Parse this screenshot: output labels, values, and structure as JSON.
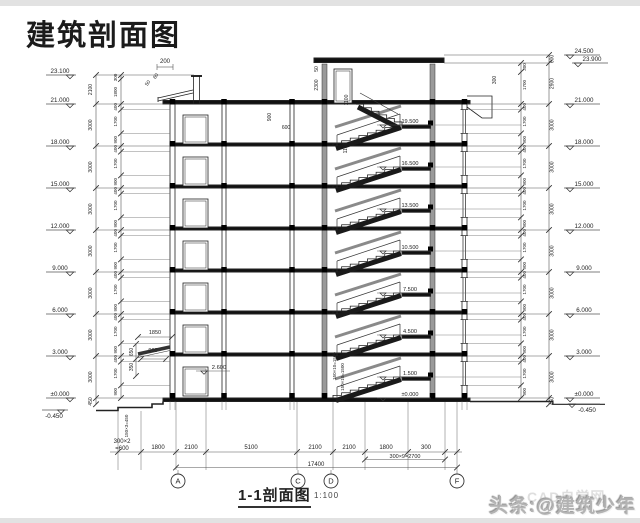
{
  "title": "建筑剖面图",
  "caption": {
    "label": "1-1剖面图",
    "scale": "1:100"
  },
  "watermark": {
    "main": "头条:@建筑少年",
    "behind": "CAD自学网"
  },
  "colors": {
    "line": "#222",
    "dim": "#555",
    "wall_gray": "#9a9a9a",
    "watermark_gray": "#b3b3b3"
  },
  "grid_bubbles": [
    {
      "label": "A",
      "x": 178
    },
    {
      "label": "C",
      "x": 298
    },
    {
      "label": "D",
      "x": 331
    },
    {
      "label": "F",
      "x": 457
    }
  ],
  "left_elevations": [
    {
      "v": "23.100",
      "y": 75
    },
    {
      "v": "21.000",
      "y": 104
    },
    {
      "v": "18.000",
      "y": 146
    },
    {
      "v": "15.000",
      "y": 188
    },
    {
      "v": "12.000",
      "y": 230
    },
    {
      "v": "9.000",
      "y": 272
    },
    {
      "v": "6.000",
      "y": 314
    },
    {
      "v": "3.000",
      "y": 356
    },
    {
      "v": "±0.000",
      "y": 398
    },
    {
      "v": "-0.450",
      "y": 410,
      "below": true
    }
  ],
  "right_elevations": [
    {
      "v": "24.500",
      "y": 55
    },
    {
      "v": "23.900",
      "y": 63,
      "indent": 8
    },
    {
      "v": "21.000",
      "y": 104
    },
    {
      "v": "18.000",
      "y": 146
    },
    {
      "v": "15.000",
      "y": 188
    },
    {
      "v": "12.000",
      "y": 230
    },
    {
      "v": "9.000",
      "y": 272
    },
    {
      "v": "6.000",
      "y": 314
    },
    {
      "v": "3.000",
      "y": 356
    },
    {
      "v": "±0.000",
      "y": 398
    },
    {
      "v": "-0.450",
      "y": 404,
      "below": true
    }
  ],
  "landing_elevations": [
    {
      "v": "19.500",
      "y": 125
    },
    {
      "v": "16.500",
      "y": 167
    },
    {
      "v": "13.500",
      "y": 209
    },
    {
      "v": "10.500",
      "y": 251
    },
    {
      "v": "7.500",
      "y": 293
    },
    {
      "v": "4.500",
      "y": 335
    },
    {
      "v": "1.500",
      "y": 377
    },
    {
      "v": "±0.000",
      "y": 398
    }
  ],
  "canopy_elevation": {
    "v": "2.600",
    "y": 371
  },
  "left_outer_chain": [
    {
      "t": "2100",
      "y": 89.5
    },
    {
      "t": "3000",
      "y": 125
    },
    {
      "t": "3000",
      "y": 167
    },
    {
      "t": "3000",
      "y": 209
    },
    {
      "t": "3000",
      "y": 251
    },
    {
      "t": "3000",
      "y": 293
    },
    {
      "t": "3000",
      "y": 335
    },
    {
      "t": "3000",
      "y": 377
    },
    {
      "t": "450",
      "y": 401.5
    }
  ],
  "left_inner_chain": [
    {
      "t": "300",
      "y": 77.5
    },
    {
      "t": "1800",
      "y": 92
    },
    {
      "t": "400",
      "y": 106.8
    },
    {
      "t": "1700",
      "y": 121.5
    },
    {
      "t": "900",
      "y": 139.7
    },
    {
      "t": "400",
      "y": 148.8
    },
    {
      "t": "1700",
      "y": 163.5
    },
    {
      "t": "900",
      "y": 181.7
    },
    {
      "t": "400",
      "y": 190.8
    },
    {
      "t": "1700",
      "y": 205.5
    },
    {
      "t": "900",
      "y": 223.7
    },
    {
      "t": "400",
      "y": 232.8
    },
    {
      "t": "1700",
      "y": 247.5
    },
    {
      "t": "900",
      "y": 265.7
    },
    {
      "t": "400",
      "y": 274.8
    },
    {
      "t": "1700",
      "y": 289.5
    },
    {
      "t": "900",
      "y": 307.7
    },
    {
      "t": "400",
      "y": 316.8
    },
    {
      "t": "1700",
      "y": 331.5
    },
    {
      "t": "900",
      "y": 349.7
    },
    {
      "t": "400",
      "y": 358.8
    },
    {
      "t": "1700",
      "y": 373.5
    },
    {
      "t": "900",
      "y": 391.7
    }
  ],
  "right_inner_chain": [
    {
      "t": "300",
      "y": 67
    },
    {
      "t": "1700",
      "y": 85
    },
    {
      "t": "400",
      "y": 106.8
    },
    {
      "t": "1700",
      "y": 121.5
    },
    {
      "t": "900",
      "y": 139.7
    },
    {
      "t": "400",
      "y": 148.8
    },
    {
      "t": "1700",
      "y": 163.5
    },
    {
      "t": "900",
      "y": 181.7
    },
    {
      "t": "400",
      "y": 190.8
    },
    {
      "t": "1700",
      "y": 205.5
    },
    {
      "t": "900",
      "y": 223.7
    },
    {
      "t": "400",
      "y": 232.8
    },
    {
      "t": "1700",
      "y": 247.5
    },
    {
      "t": "900",
      "y": 265.7
    },
    {
      "t": "400",
      "y": 274.8
    },
    {
      "t": "1700",
      "y": 289.5
    },
    {
      "t": "900",
      "y": 307.7
    },
    {
      "t": "400",
      "y": 316.8
    },
    {
      "t": "1700",
      "y": 331.5
    },
    {
      "t": "900",
      "y": 349.7
    },
    {
      "t": "400",
      "y": 358.8
    },
    {
      "t": "1700",
      "y": 373.5
    },
    {
      "t": "900",
      "y": 391.7
    }
  ],
  "right_outer_chain": [
    {
      "t": "600",
      "y": 59
    },
    {
      "t": "2900",
      "y": 83.5
    },
    {
      "t": "3000",
      "y": 125
    },
    {
      "t": "3000",
      "y": 167
    },
    {
      "t": "3000",
      "y": 209
    },
    {
      "t": "3000",
      "y": 251
    },
    {
      "t": "3000",
      "y": 293
    },
    {
      "t": "3000",
      "y": 335
    },
    {
      "t": "3000",
      "y": 377
    },
    {
      "t": "450",
      "y": 401
    }
  ],
  "bottom_dims": {
    "row1": [
      {
        "t": "300×2",
        "cx": 122,
        "y": 443
      },
      {
        "t": "=600",
        "cx": 122,
        "y": 450
      },
      {
        "t": "1800",
        "cx": 158,
        "y": 449
      },
      {
        "t": "2100",
        "cx": 191,
        "y": 449
      },
      {
        "t": "5100",
        "cx": 251,
        "y": 449
      },
      {
        "t": "2100",
        "cx": 315,
        "y": 449
      },
      {
        "t": "2100",
        "cx": 349,
        "y": 449
      },
      {
        "t": "1800",
        "cx": 386,
        "y": 449
      },
      {
        "t": "300",
        "cx": 426,
        "y": 449
      }
    ],
    "row2": {
      "t": "300×9=2700",
      "cx": 405,
      "y": 458
    },
    "total": {
      "t": "17400",
      "cx": 316,
      "y": 466
    }
  },
  "misc_labels": [
    {
      "t": "200",
      "x": 165,
      "y": 63,
      "s": 6
    },
    {
      "t": "50",
      "x": 149,
      "y": 84,
      "s": 5,
      "r": -55
    },
    {
      "t": "60",
      "x": 157,
      "y": 77,
      "s": 5,
      "r": -55
    },
    {
      "t": "900",
      "x": 271,
      "y": 117,
      "s": 5,
      "r": -90
    },
    {
      "t": "600",
      "x": 286,
      "y": 129,
      "s": 5
    },
    {
      "t": "50",
      "x": 318,
      "y": 69,
      "s": 5,
      "r": -90
    },
    {
      "t": "2300",
      "x": 318,
      "y": 85,
      "s": 5,
      "r": -90
    },
    {
      "t": "1100",
      "x": 348,
      "y": 100,
      "s": 5,
      "r": -90
    },
    {
      "t": "1100",
      "x": 347,
      "y": 148,
      "s": 5,
      "r": -90
    },
    {
      "t": "300",
      "x": 496,
      "y": 80,
      "s": 5,
      "r": -90
    },
    {
      "t": "1850",
      "x": 155,
      "y": 334,
      "s": 5.5
    },
    {
      "t": "900",
      "x": 153,
      "y": 352,
      "s": 5.5
    },
    {
      "t": "650",
      "x": 133,
      "y": 352,
      "s": 5,
      "r": -90
    },
    {
      "t": "350",
      "x": 133,
      "y": 367,
      "s": 5,
      "r": -90
    },
    {
      "t": "150×10=1500",
      "x": 336,
      "y": 366,
      "s": 4.5,
      "r": -90
    },
    {
      "t": "150×10=1500",
      "x": 344,
      "y": 377,
      "s": 4.5,
      "r": -90
    },
    {
      "t": "150×3=450",
      "x": 128,
      "y": 426,
      "s": 4.5,
      "r": -90
    }
  ]
}
